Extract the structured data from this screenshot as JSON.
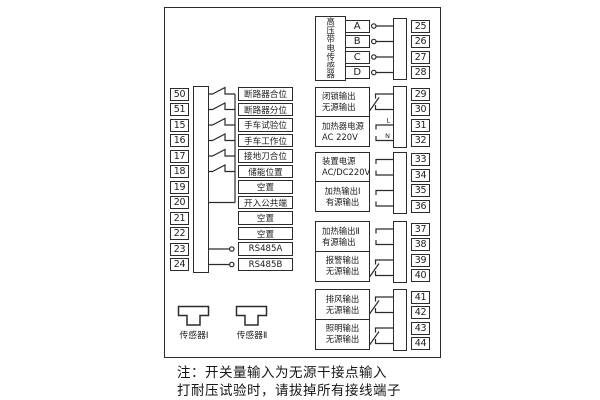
{
  "diagram": {
    "note": {
      "line1": "注：开关量输入为无源干接点输入",
      "line2": "打耐压试验时，请拔掉所有接线端子"
    },
    "left_inputs": {
      "rows": [
        {
          "num": "50",
          "label": "断路器合位"
        },
        {
          "num": "51",
          "label": "断路器分位"
        },
        {
          "num": "15",
          "label": "手车试验位"
        },
        {
          "num": "16",
          "label": "手车工作位"
        },
        {
          "num": "17",
          "label": "接地刀合位"
        },
        {
          "num": "18",
          "label": "储能位置"
        },
        {
          "num": "19",
          "label": "空置"
        },
        {
          "num": "20",
          "label": "开入公共端"
        },
        {
          "num": "21",
          "label": "空置"
        },
        {
          "num": "22",
          "label": "空置"
        },
        {
          "num": "23",
          "label": "RS485A"
        },
        {
          "num": "24",
          "label": "RS485B"
        }
      ]
    },
    "hv_sensor_block": {
      "title": "高压带电传感器",
      "phases": [
        "A",
        "B",
        "C",
        "D"
      ],
      "terminals": [
        "25",
        "26",
        "27",
        "28"
      ]
    },
    "output_blocks": [
      {
        "line1": "闭锁输出",
        "line2": "无源输出",
        "terminals": [
          "29",
          "30"
        ]
      },
      {
        "line1": "加热器电源",
        "line2": "AC 220V",
        "terminals": [
          "31",
          "32"
        ],
        "wire_labels": [
          "L",
          "N"
        ]
      },
      {
        "line1": "装置电源",
        "line2": "AC/DC220V",
        "terminals": [
          "33",
          "34"
        ]
      },
      {
        "line1": "加热输出Ⅰ",
        "line2": "有源输出",
        "terminals": [
          "35",
          "36"
        ]
      },
      {
        "line1": "加热输出Ⅱ",
        "line2": "有源输出",
        "terminals": [
          "37",
          "38"
        ]
      },
      {
        "line1": "报警输出",
        "line2": "无源输出",
        "terminals": [
          "39",
          "40"
        ]
      },
      {
        "line1": "排风输出",
        "line2": "无源输出",
        "terminals": [
          "41",
          "42"
        ]
      },
      {
        "line1": "照明输出",
        "line2": "无源输出",
        "terminals": [
          "43",
          "44"
        ]
      }
    ],
    "sensors": [
      {
        "label": "传感器Ⅰ"
      },
      {
        "label": "传感器Ⅱ"
      }
    ],
    "colors": {
      "line": "#2b2b2b",
      "background": "#ffffff",
      "text": "#1c1c1c"
    }
  }
}
